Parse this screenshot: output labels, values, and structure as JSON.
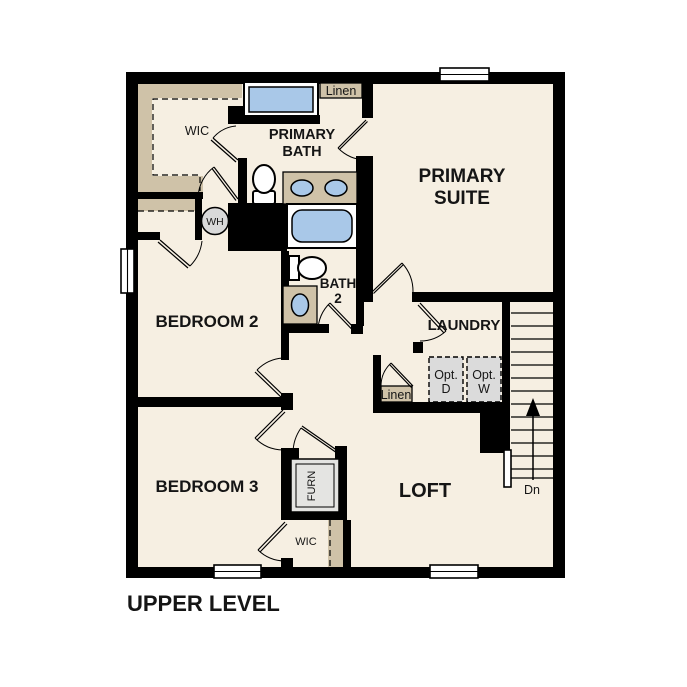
{
  "title": "UPPER LEVEL",
  "rooms": {
    "primary_suite": [
      "PRIMARY",
      "SUITE"
    ],
    "primary_bath": [
      "PRIMARY",
      "BATH"
    ],
    "bath2": [
      "BATH",
      "2"
    ],
    "bedroom2": "BEDROOM 2",
    "bedroom3": "BEDROOM 3",
    "laundry": "LAUNDRY",
    "loft": "LOFT",
    "wic_primary": "WIC",
    "wic_bedroom3": "WIC"
  },
  "closets": {
    "linen_bath": "Linen",
    "linen_hall": "Linen"
  },
  "fixtures": {
    "water_heater": "WH",
    "furnace": "FURN",
    "optional_dryer": [
      "Opt.",
      "D"
    ],
    "optional_washer": [
      "Opt.",
      "W"
    ]
  },
  "stairs": {
    "direction": "Dn"
  },
  "colors": {
    "wall": "#000000",
    "floor": "#f6efe2",
    "shelving": "#cfc2a8",
    "water_fixture": "#a9c8e8",
    "appliance": "#dbdbdb",
    "background": "#ffffff"
  }
}
